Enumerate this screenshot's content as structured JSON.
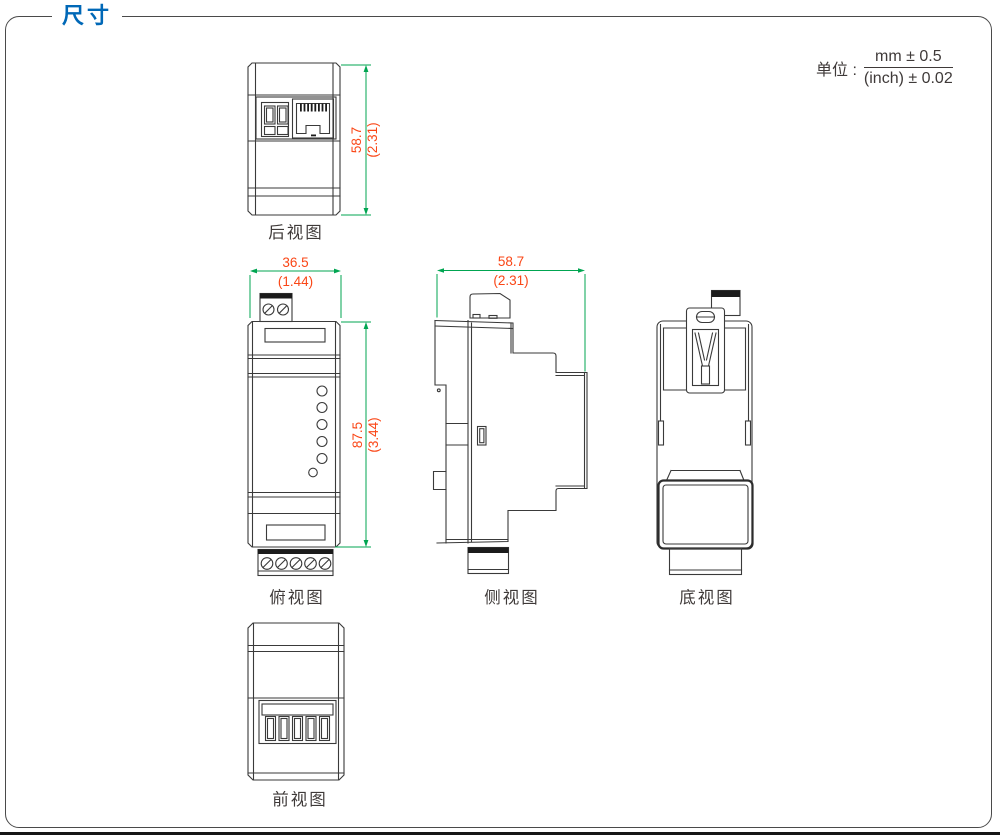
{
  "page": {
    "title": "尺寸"
  },
  "unit": {
    "label": "单位 :",
    "numerator": "mm ± 0.5",
    "denominator": "(inch) ± 0.02"
  },
  "colors": {
    "accent_blue": "#0068b7",
    "dimension_line_green": "#00a551",
    "dimension_text_red": "#fa4616",
    "drawing_line": "#3a3a3a"
  },
  "views": {
    "rear": {
      "label": "后视图",
      "height_mm": "58.7",
      "height_inch": "(2.31)"
    },
    "top": {
      "label": "俯视图",
      "width_mm": "36.5",
      "width_inch": "(1.44)",
      "height_mm": "87.5",
      "height_inch": "(3.44)"
    },
    "side": {
      "label": "侧视图",
      "width_mm": "58.7",
      "width_inch": "(2.31)"
    },
    "bottom": {
      "label": "底视图"
    },
    "front": {
      "label": "前视图"
    }
  }
}
